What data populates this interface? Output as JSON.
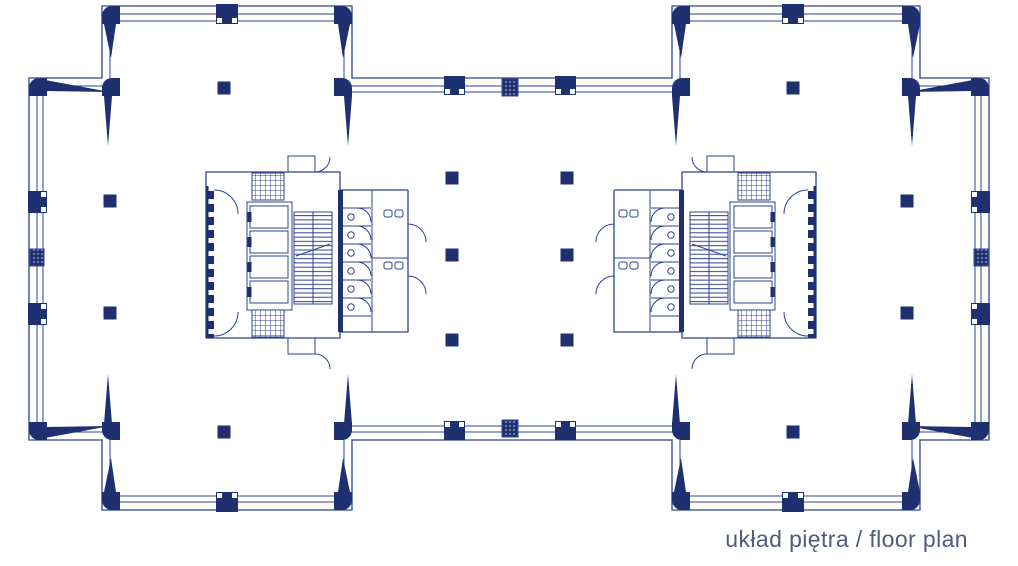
{
  "caption": {
    "text": "układ piętra / floor plan"
  },
  "palette": {
    "line": "#2e4391",
    "dark": "#1e3070",
    "background": "#ffffff",
    "caption": "#4e5c7d"
  },
  "plan": {
    "type": "architectural-floor-plan",
    "cores": {
      "count": 2,
      "elevators_per_core": 4,
      "stairs_per_core": 1,
      "toilet_stalls_per_core": 6
    },
    "freestanding_columns": [
      {
        "x": 110,
        "y": 201
      },
      {
        "x": 110,
        "y": 313
      },
      {
        "x": 907,
        "y": 201
      },
      {
        "x": 907,
        "y": 313
      },
      {
        "x": 224,
        "y": 88
      },
      {
        "x": 793,
        "y": 88
      },
      {
        "x": 224,
        "y": 432
      },
      {
        "x": 793,
        "y": 432
      },
      {
        "x": 452,
        "y": 178
      },
      {
        "x": 567,
        "y": 178
      },
      {
        "x": 452,
        "y": 255
      },
      {
        "x": 567,
        "y": 255
      },
      {
        "x": 452,
        "y": 340
      },
      {
        "x": 567,
        "y": 340
      }
    ],
    "wall_columns": [
      {
        "x": 216,
        "y": 4,
        "w": 22,
        "h": 20,
        "side": "s"
      },
      {
        "x": 782,
        "y": 4,
        "w": 22,
        "h": 20,
        "side": "s"
      },
      {
        "x": 444,
        "y": 76,
        "w": 21,
        "h": 19,
        "side": "s"
      },
      {
        "x": 555,
        "y": 76,
        "w": 21,
        "h": 19,
        "side": "s"
      },
      {
        "x": 971,
        "y": 191,
        "w": 19,
        "h": 22,
        "side": "w"
      },
      {
        "x": 971,
        "y": 303,
        "w": 19,
        "h": 22,
        "side": "w"
      },
      {
        "x": 28,
        "y": 191,
        "w": 19,
        "h": 22,
        "side": "e"
      },
      {
        "x": 28,
        "y": 303,
        "w": 19,
        "h": 22,
        "side": "e"
      },
      {
        "x": 444,
        "y": 421,
        "w": 21,
        "h": 19,
        "side": "n"
      },
      {
        "x": 555,
        "y": 421,
        "w": 21,
        "h": 19,
        "side": "n"
      },
      {
        "x": 216,
        "y": 492,
        "w": 22,
        "h": 20,
        "side": "n"
      },
      {
        "x": 782,
        "y": 492,
        "w": 22,
        "h": 20,
        "side": "n"
      }
    ],
    "mullions": [
      {
        "x": 502,
        "y": 79,
        "w": 16,
        "h": 17
      },
      {
        "x": 502,
        "y": 420,
        "w": 16,
        "h": 17
      },
      {
        "x": 30,
        "y": 249,
        "w": 14,
        "h": 17
      },
      {
        "x": 974,
        "y": 249,
        "w": 14,
        "h": 17
      }
    ],
    "corner_blocks": [
      {
        "x": 102,
        "y": 6,
        "corner": "tl"
      },
      {
        "x": 334,
        "y": 6,
        "corner": "tr"
      },
      {
        "x": 672,
        "y": 6,
        "corner": "tl"
      },
      {
        "x": 902,
        "y": 6,
        "corner": "tr"
      },
      {
        "x": 334,
        "y": 78,
        "corner": "tr"
      },
      {
        "x": 672,
        "y": 78,
        "corner": "tl"
      },
      {
        "x": 102,
        "y": 78,
        "corner": "tl"
      },
      {
        "x": 902,
        "y": 78,
        "corner": "tr"
      },
      {
        "x": 29,
        "y": 78,
        "corner": "tl"
      },
      {
        "x": 971,
        "y": 78,
        "corner": "tr"
      },
      {
        "x": 29,
        "y": 422,
        "corner": "bl"
      },
      {
        "x": 971,
        "y": 422,
        "corner": "br"
      },
      {
        "x": 102,
        "y": 422,
        "corner": "bl"
      },
      {
        "x": 902,
        "y": 422,
        "corner": "br"
      },
      {
        "x": 334,
        "y": 422,
        "corner": "br"
      },
      {
        "x": 672,
        "y": 422,
        "corner": "bl"
      },
      {
        "x": 102,
        "y": 492,
        "corner": "bl"
      },
      {
        "x": 334,
        "y": 492,
        "corner": "br"
      },
      {
        "x": 672,
        "y": 492,
        "corner": "bl"
      },
      {
        "x": 902,
        "y": 492,
        "corner": "br"
      }
    ],
    "braces": [
      {
        "points": "45,80 110,92 45,91"
      },
      {
        "points": "45,438 110,426 45,427"
      },
      {
        "points": "973,80 908,92 973,91"
      },
      {
        "points": "973,438 908,426 973,427"
      },
      {
        "points": "104,24 116,24 111,58"
      },
      {
        "points": "338,24 350,24 343,58"
      },
      {
        "points": "674,24 686,24 681,58"
      },
      {
        "points": "908,24 920,24 913,58"
      },
      {
        "points": "104,492 116,492 111,458"
      },
      {
        "points": "338,492 350,492 343,458"
      },
      {
        "points": "674,492 686,492 681,458"
      },
      {
        "points": "908,492 920,492 913,458"
      },
      {
        "points": "104,96 112,96 108,146"
      },
      {
        "points": "344,96 352,96 348,146"
      },
      {
        "points": "672,96 680,96 676,146"
      },
      {
        "points": "908,96 916,96 912,146"
      },
      {
        "points": "104,424 112,424 108,374"
      },
      {
        "points": "344,424 352,424 348,374"
      },
      {
        "points": "672,424 680,424 676,374"
      },
      {
        "points": "908,424 916,424 912,374"
      }
    ]
  }
}
